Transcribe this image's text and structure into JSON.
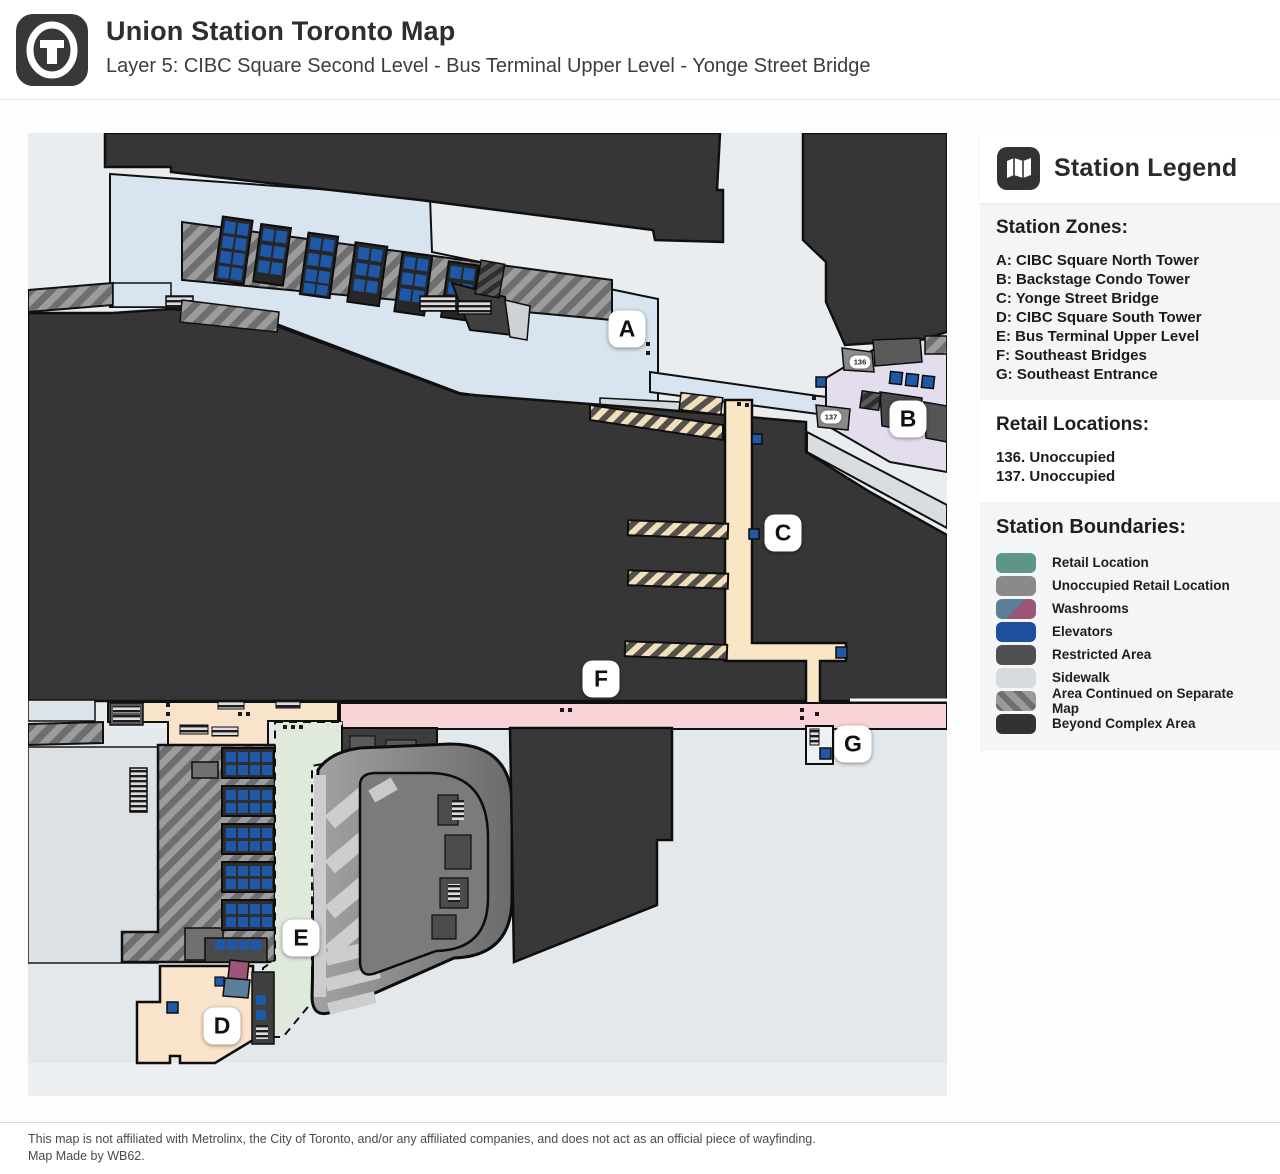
{
  "header": {
    "title": "Union Station Toronto Map",
    "subtitle": "Layer 5: CIBC Square Second Level - Bus Terminal Upper Level - Yonge Street Bridge",
    "logo_icon": "union-station-t-logo"
  },
  "legend": {
    "icon": "map-icon",
    "title": "Station Legend",
    "zones_heading": "Station Zones:",
    "zones": [
      "A: CIBC Square North Tower",
      "B: Backstage Condo Tower",
      "C: Yonge Street Bridge",
      "D: CIBC Square South Tower",
      "E: Bus Terminal Upper Level",
      "F: Southeast Bridges",
      "G: Southeast Entrance"
    ],
    "retail_heading": "Retail Locations:",
    "retail": [
      "136. Unoccupied",
      "137. Unoccupied"
    ],
    "boundaries_heading": "Station Boundaries:",
    "boundaries": [
      {
        "label": "Retail Location",
        "swatch": "solid",
        "color": "#5f9587"
      },
      {
        "label": "Unoccupied Retail Location",
        "swatch": "solid",
        "color": "#8a8a8a"
      },
      {
        "label": "Washrooms",
        "swatch": "washroom",
        "colors": [
          "#5c7f99",
          "#9c5578"
        ]
      },
      {
        "label": "Elevators",
        "swatch": "solid",
        "color": "#1d4f9e"
      },
      {
        "label": "Restricted Area",
        "swatch": "solid",
        "color": "#4f4f4f"
      },
      {
        "label": "Sidewalk",
        "swatch": "solid",
        "color": "#d8dbdd"
      },
      {
        "label": "Area Continued on Separate Map",
        "swatch": "hatch",
        "color": "#9b9b9b"
      },
      {
        "label": "Beyond Complex Area",
        "swatch": "solid",
        "color": "#323232"
      }
    ]
  },
  "map": {
    "zone_labels": [
      {
        "label": "A",
        "x": 627,
        "y": 329
      },
      {
        "label": "B",
        "x": 908,
        "y": 419
      },
      {
        "label": "C",
        "x": 783,
        "y": 533
      },
      {
        "label": "D",
        "x": 222,
        "y": 1026
      },
      {
        "label": "E",
        "x": 301,
        "y": 938
      },
      {
        "label": "F",
        "x": 601,
        "y": 679
      },
      {
        "label": "G",
        "x": 853,
        "y": 744
      }
    ],
    "retail_badges": [
      {
        "label": "136",
        "x": 860,
        "y": 362
      },
      {
        "label": "137",
        "x": 831,
        "y": 417
      }
    ],
    "zone_colors": {
      "A": "#d8e4f0",
      "B": "#e4ddee",
      "C": "#f8e6c4",
      "D": "#fae3cb",
      "E": "#dfe9dc",
      "F": "#f8d4d8",
      "sidewalk": "#dce1e5",
      "beyond": "#363636"
    }
  },
  "footer": {
    "disclaimer": "This map is not affiliated with Metrolinx, the City of Toronto, and/or any affiliated companies, and does not act as an official piece of wayfinding.",
    "credit": "Map Made by WB62."
  }
}
